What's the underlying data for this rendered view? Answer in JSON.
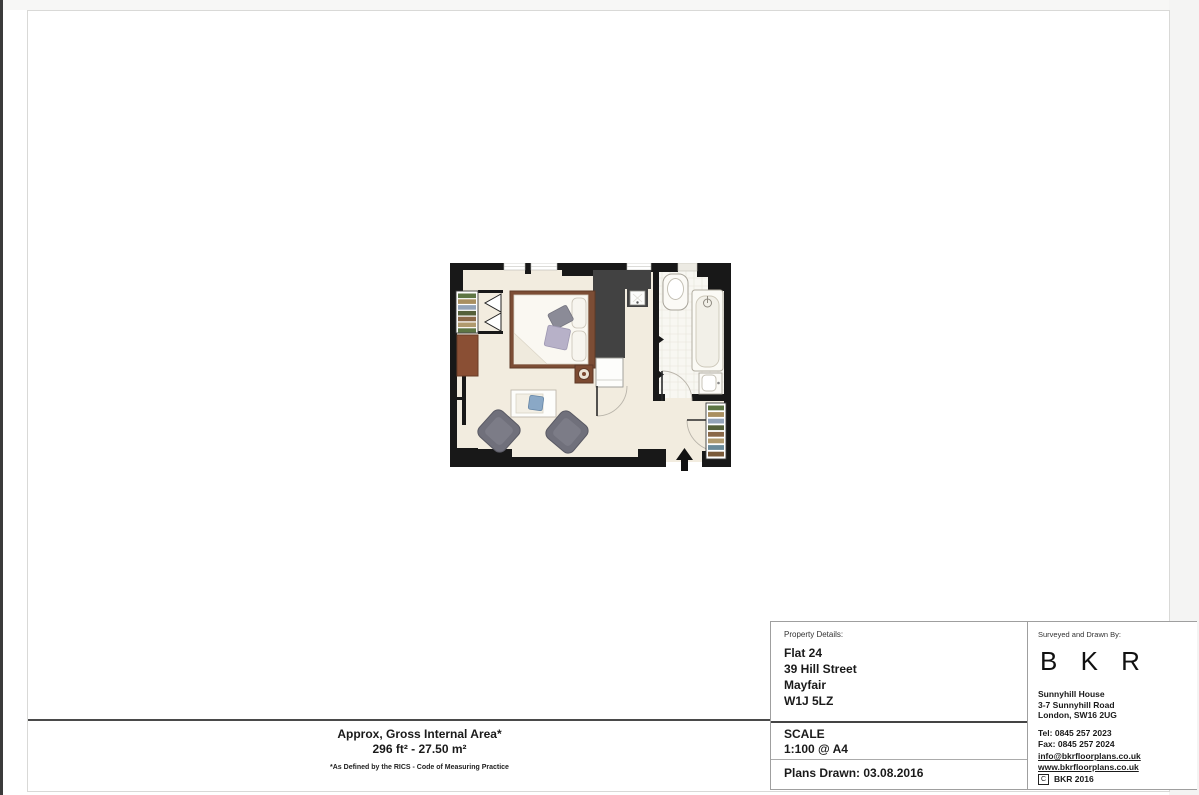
{
  "area_summary": {
    "title": "Approx, Gross Internal Area*",
    "value": "296 ft² - 27.50 m²",
    "footnote": "*As Defined by the RICS - Code of Measuring Practice"
  },
  "property_details": {
    "label": "Property Details:",
    "address_lines": [
      "Flat 24",
      "39 Hill Street",
      "Mayfair",
      "W1J 5LZ"
    ],
    "scale_label": "SCALE",
    "scale_value": "1:100 @ A4",
    "plans_drawn": "Plans Drawn: 03.08.2016"
  },
  "surveyor": {
    "label": "Surveyed and Drawn By:",
    "logo_text": "B K R",
    "address_lines": [
      "Sunnyhill House",
      "3-7 Sunnyhill Road",
      "London, SW16 2UG"
    ],
    "tel": "Tel: 0845 257 2023",
    "fax": "Fax: 0845 257 2024",
    "email": "info@bkrfloorplans.co.uk",
    "website": "www.bkrfloorplans.co.uk",
    "copyright_mark": "C",
    "copyright_text": "BKR 2016"
  },
  "floor_plan": {
    "colors": {
      "wall": "#181818",
      "floor": "#f2ecdf",
      "bath_floor": "#f8f7f2",
      "wardrobe": "#424242",
      "bed_frame": "#7c4d35",
      "cabinet": "#8a4f34",
      "armchair": "#70707b",
      "cushion_gray": "#8b8b97",
      "cushion_purple": "#b7b1c8",
      "table_item_blue": "#8aa8c6"
    },
    "shelf_stripe_colors": [
      "#5d7544",
      "#a98f60",
      "#93a3b8",
      "#55603a",
      "#8a6848",
      "#b09a6e",
      "#6a8a9a",
      "#7a5a3a"
    ]
  }
}
